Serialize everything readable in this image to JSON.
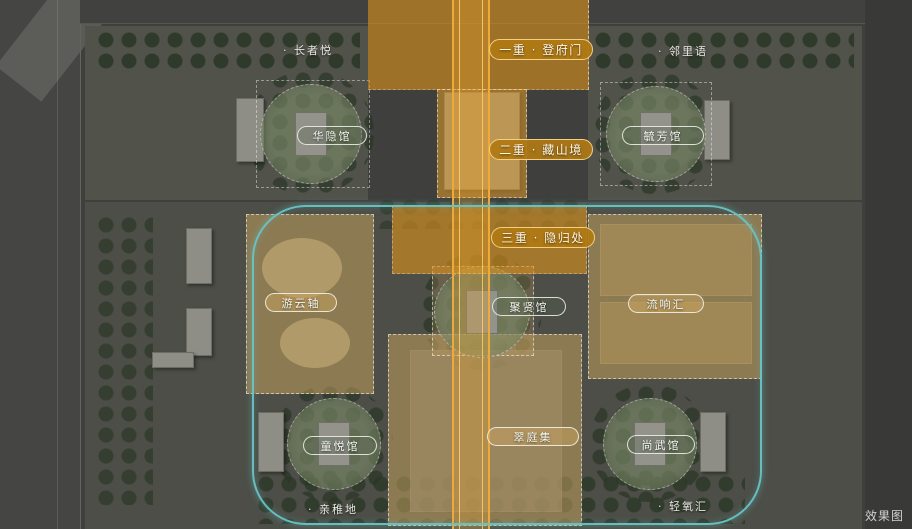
{
  "meta": {
    "watermark": "效果图"
  },
  "zones": [
    {
      "label": "一重 · 登府门"
    },
    {
      "label": "二重 · 藏山境"
    },
    {
      "label": "三重 · 隐归处"
    }
  ],
  "venues": [
    {
      "label": "华隐馆"
    },
    {
      "label": "毓芳馆"
    },
    {
      "label": "游云轴"
    },
    {
      "label": "聚贤馆"
    },
    {
      "label": "流响汇"
    },
    {
      "label": "童悦馆"
    },
    {
      "label": "翠庭集"
    },
    {
      "label": "尚武馆"
    }
  ],
  "poi": [
    {
      "label": "· 长者悦"
    },
    {
      "label": "· 邻里语"
    },
    {
      "label": "· 亲稚地"
    },
    {
      "label": "· 轻氧汇"
    }
  ],
  "colors": {
    "axis_orange": "#EFA83A",
    "zone_orange": "#DD921B",
    "teal_boundary": "#68C4C6",
    "tan_zone": "#CBA560",
    "pill_border": "#F3CF82"
  }
}
